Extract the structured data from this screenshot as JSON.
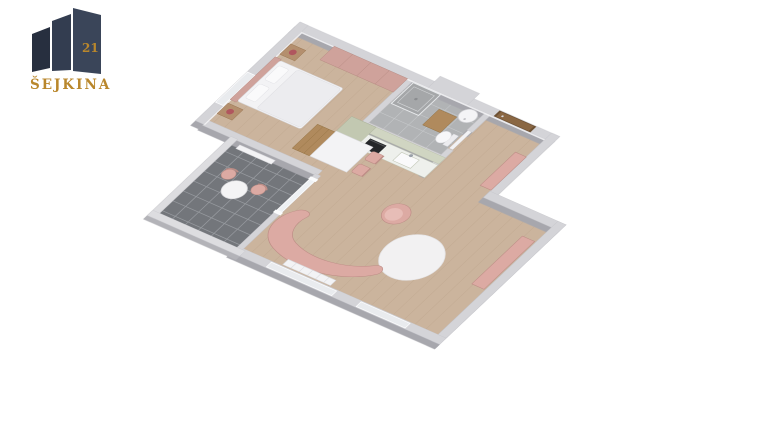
{
  "logo": {
    "brand": "ŠEJKINA",
    "number": "21"
  },
  "colors": {
    "bg": "#ffffff",
    "wall": "#d4d4d8",
    "wall_side": "#a7a7ad",
    "parapet": "#dddde0",
    "parapet_side": "#b3b3b8",
    "floor_wood": "#cbb49d",
    "plank": "#b89f87",
    "bath_floor": "#b1b3b5",
    "bath_grout": "#c9cbcd",
    "shower": "#a5a7a9",
    "balcony_floor": "#73767b",
    "balcony_grout": "#999ca1",
    "sage": "#c2c8b1",
    "sage_light": "#d0d5c2",
    "counter": "#eef0ec",
    "oven": "#25272a",
    "pink": "#dcaaa3",
    "pink_muted": "#cfa29b",
    "pink_deep": "#bd8d86",
    "pink_pale": "#e7bdb7",
    "white_furn": "#f3f3f5",
    "white_stroke": "#d9d9dd",
    "wood_door": "#8a6743",
    "door_frame": "#6d5134",
    "wood_cab": "#b08a5d",
    "nightstand": "#b48f6e",
    "lamp": "#b0565e",
    "glass": "#eef1f4",
    "window": "#e9ebee",
    "boiler": "#f4f4f6",
    "logo_navy_dark": "#272f3f",
    "logo_navy": "#333d50",
    "logo_navy_light": "#3a4559",
    "logo_gold": "#b9872c"
  },
  "scene": {
    "type": "3d-floor-plan",
    "rooms": [
      {
        "name": "bedroom",
        "furniture": [
          "double-bed",
          "headboard",
          "pillows",
          "nightstand-north",
          "nightstand-south",
          "table-lamps",
          "wardrobe",
          "wood-cabinet",
          "west-window"
        ]
      },
      {
        "name": "bathroom",
        "furniture": [
          "shower",
          "water-heater-boiler",
          "toilet",
          "wood-vanity"
        ]
      },
      {
        "name": "kitchen",
        "furniture": [
          "tall-cabinet",
          "upper-cabinets",
          "counter",
          "oven",
          "sink"
        ]
      },
      {
        "name": "hallway",
        "furniture": [
          "entry-door",
          "pink-bench"
        ]
      },
      {
        "name": "living-room",
        "furniture": [
          "dining-table",
          "dining-chairs",
          "armchair",
          "round-rug",
          "curved-sofa",
          "sideboard",
          "radiator",
          "south-windows"
        ]
      },
      {
        "name": "balcony",
        "furniture": [
          "bistro-table",
          "balcony-chairs",
          "radiator",
          "glass-door",
          "tiled-floor"
        ]
      }
    ]
  }
}
